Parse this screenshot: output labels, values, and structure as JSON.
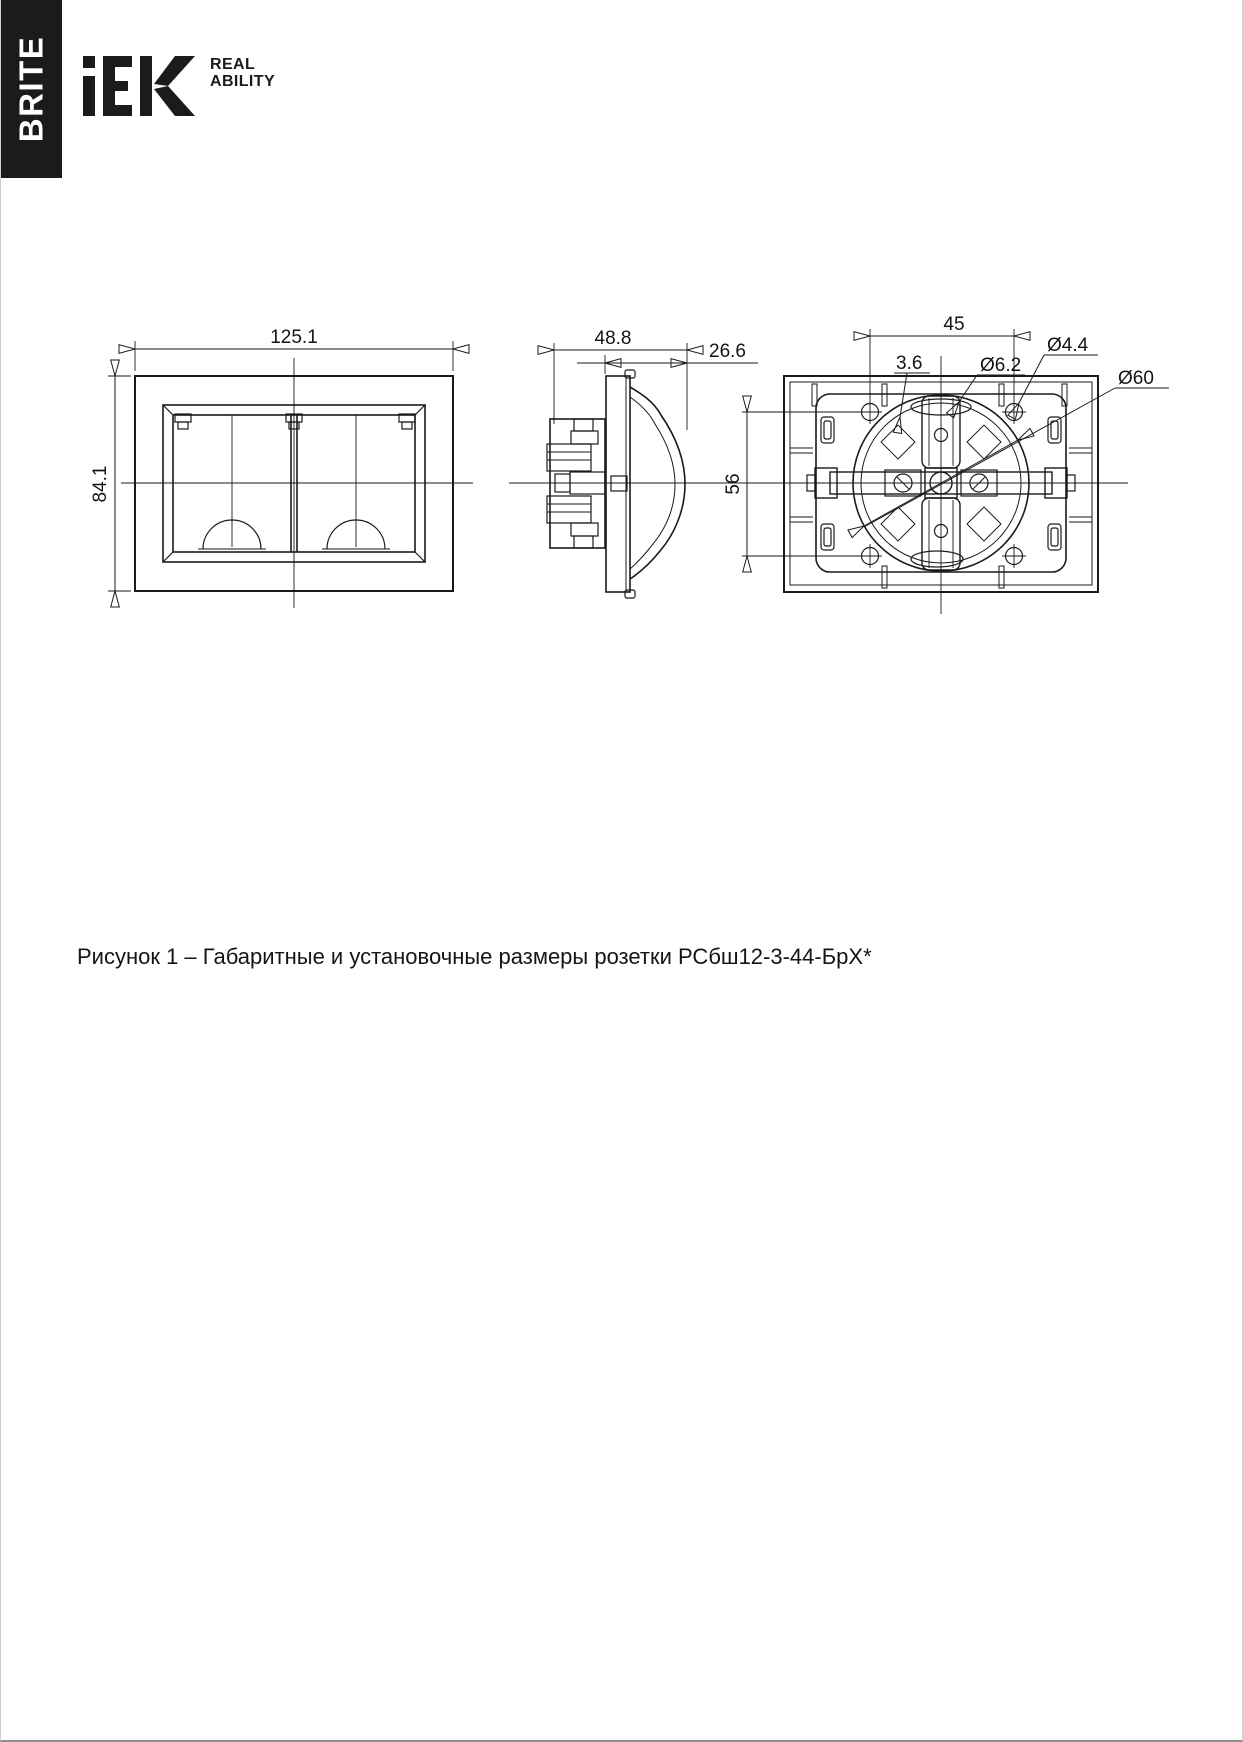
{
  "header": {
    "series": "BRITE",
    "logo_text": "IEK",
    "tagline_line1": "REAL",
    "tagline_line2": "ABILITY"
  },
  "figure": {
    "caption": "Рисунок 1 – Габаритные и установочные размеры розетки РСбш12-3-44-БрХ*"
  },
  "dimensions": {
    "front_width": "125.1",
    "front_height": "84.1",
    "side_depth": "48.8",
    "side_protrusion": "26.6",
    "mount_hole_spacing": "45",
    "slot_width": "3.6",
    "oval_hole_diameter": "Ø6.2",
    "screw_hole_diameter": "Ø4.4",
    "support_circle_diameter": "Ø60",
    "claw_span": "56"
  },
  "colors": {
    "line": "#1a1a1a",
    "background": "#ffffff",
    "brand_bar": "#1b1b1d"
  }
}
